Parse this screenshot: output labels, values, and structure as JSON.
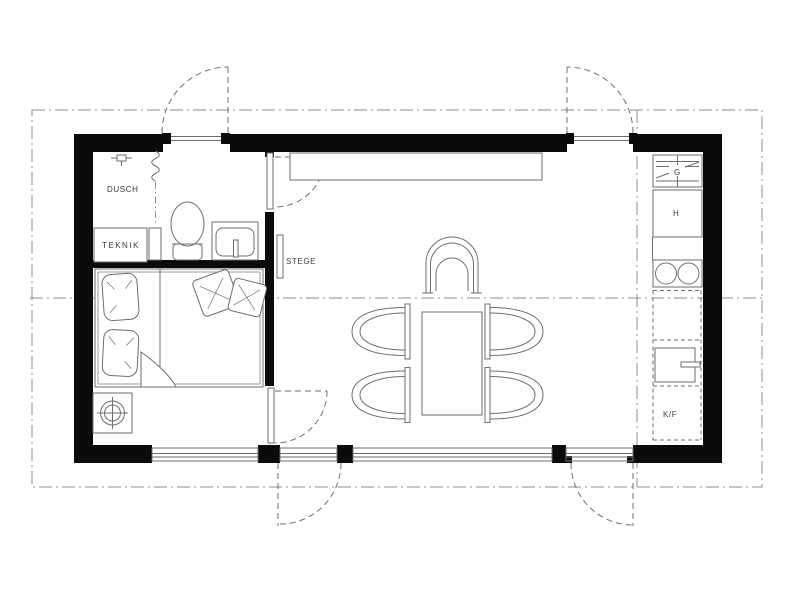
{
  "drawing": {
    "type": "floor-plan",
    "labels": {
      "shower": "DUSCH",
      "utility_closet": "TEKNIK",
      "loft_ladder": "STEGE",
      "wardrobe_unit": "G",
      "tall_cabinet_unit": "H",
      "fridge_freezer": "K/F"
    },
    "fixtures": [
      "shower-head",
      "shower-curtain",
      "toilet",
      "washbasin",
      "utility-closet",
      "double-bed",
      "pillows",
      "duvet-fold",
      "stove-flue-symbol",
      "loft-ladder",
      "wall-bench",
      "armchair",
      "dining-table",
      "dining-chair",
      "wardrobe-shelving",
      "tall-cabinet",
      "cooktop-2-burner",
      "oven",
      "fridge-freezer",
      "exterior-door",
      "interior-door",
      "window-band",
      "module-grid-line",
      "roof-overhang-outline"
    ],
    "colors": {
      "wall": "#0b0b0b",
      "line": "#6e6e6e",
      "grid": "#8f8f8f",
      "text": "#3a3a3a",
      "bg": "#ffffff"
    }
  }
}
